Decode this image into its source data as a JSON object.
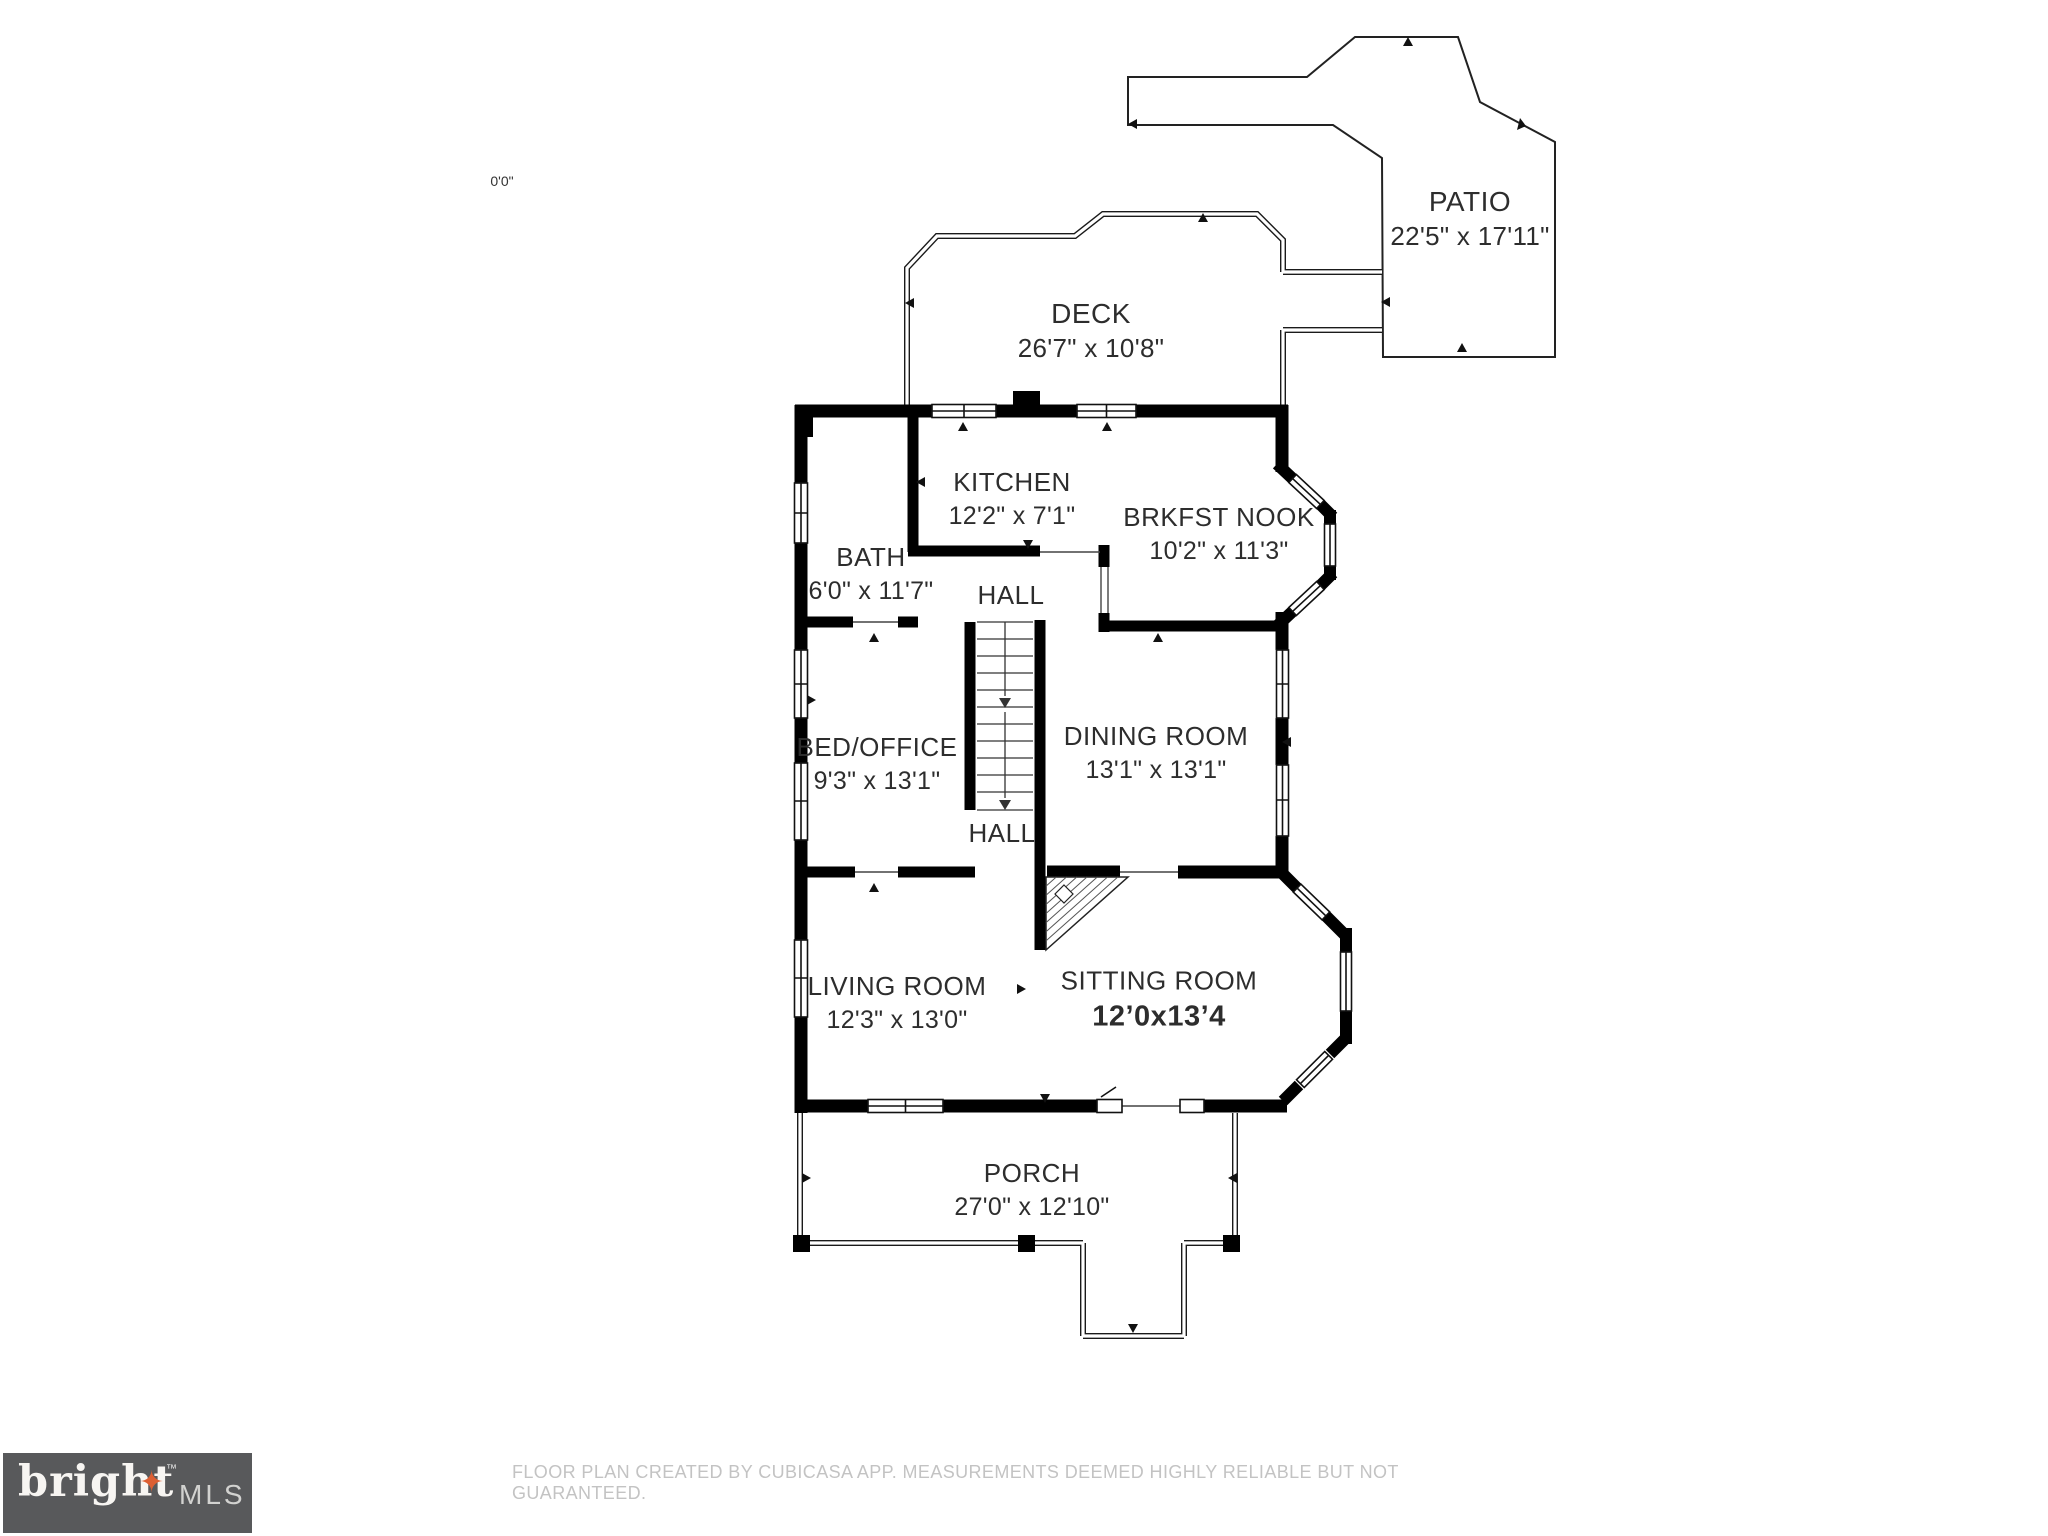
{
  "scale_marker": "0'0\"",
  "rooms": [
    {
      "id": "patio",
      "name": "PATIO",
      "dims": "22'5\" x 17'11\""
    },
    {
      "id": "deck",
      "name": "DECK",
      "dims": "26'7\" x 10'8\""
    },
    {
      "id": "kitchen",
      "name": "KITCHEN",
      "dims": "12'2\" x 7'1\""
    },
    {
      "id": "brkfst-nook",
      "name": "BRKFST NOOK",
      "dims": "10'2\" x 11'3\""
    },
    {
      "id": "bath",
      "name": "BATH",
      "dims": "6'0\" x 11'7\""
    },
    {
      "id": "hall-upper",
      "name": "HALL",
      "dims": ""
    },
    {
      "id": "bed-office",
      "name": "BED/OFFICE",
      "dims": "9'3\" x 13'1\""
    },
    {
      "id": "dining-room",
      "name": "DINING ROOM",
      "dims": "13'1\" x 13'1\""
    },
    {
      "id": "hall-lower",
      "name": "HALL",
      "dims": ""
    },
    {
      "id": "living-room",
      "name": "LIVING ROOM",
      "dims": "12'3\" x 13'0\""
    },
    {
      "id": "sitting-room",
      "name": "SITTING ROOM",
      "dims": "12’0x13’4"
    },
    {
      "id": "porch",
      "name": "PORCH",
      "dims": "27'0\" x 12'10\""
    }
  ],
  "footer": {
    "disclaimer": "FLOOR PLAN CREATED BY CUBICASA APP. MEASUREMENTS DEEMED HIGHLY RELIABLE BUT NOT GUARANTEED."
  },
  "logo": {
    "brand": "bright",
    "tm": "™",
    "suffix": "MLS",
    "star_glyph": "✦"
  },
  "colors": {
    "walls": "#000000",
    "label_text": "#2d2d2d",
    "footer_text": "#c3c3c3",
    "logo_box": "#58595b",
    "logo_accent": "#dd5f33"
  }
}
